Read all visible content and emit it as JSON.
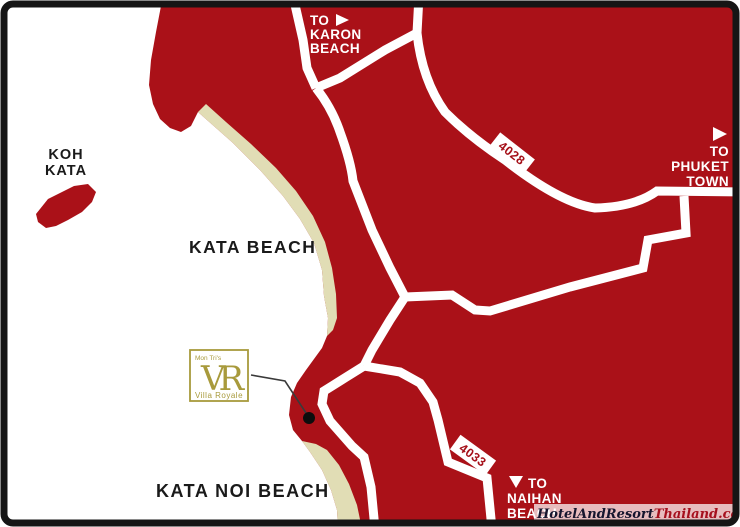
{
  "map": {
    "labels": {
      "koh_kata_line1": "KOH",
      "koh_kata_line2": "KATA",
      "kata_beach": "KATA BEACH",
      "kata_noi_beach": "KATA NOI BEACH"
    },
    "directions": {
      "karon": {
        "line1": "TO",
        "line2": "KARON",
        "line3": "BEACH",
        "arrow": "right"
      },
      "phuket": {
        "line1": "TO",
        "line2": "PHUKET",
        "line3": "TOWN",
        "arrow": "right"
      },
      "naihan": {
        "line1": "TO",
        "line2": "NAIHAN",
        "line3": "BEACH",
        "arrow": "down"
      }
    },
    "routes": {
      "r4028": "4028",
      "r4033": "4033"
    },
    "marker": {
      "brand_top": "Mon Tri's",
      "monogram": "VR",
      "brand_bottom": "Villa Royale"
    },
    "watermark": {
      "part1": "HotelAndResort",
      "part2": "Thailand.com"
    },
    "colors": {
      "land": "#aa1118",
      "beach_sand": "#e1ddb5",
      "sea": "#ffffff",
      "road": "#ffffff",
      "route_text": "#a51019",
      "logo_gold": "#a89a3c",
      "label_black": "#1a1a1a",
      "frame_black": "#151515",
      "watermark_dark": "#16162e",
      "watermark_red": "#a5101e"
    }
  }
}
